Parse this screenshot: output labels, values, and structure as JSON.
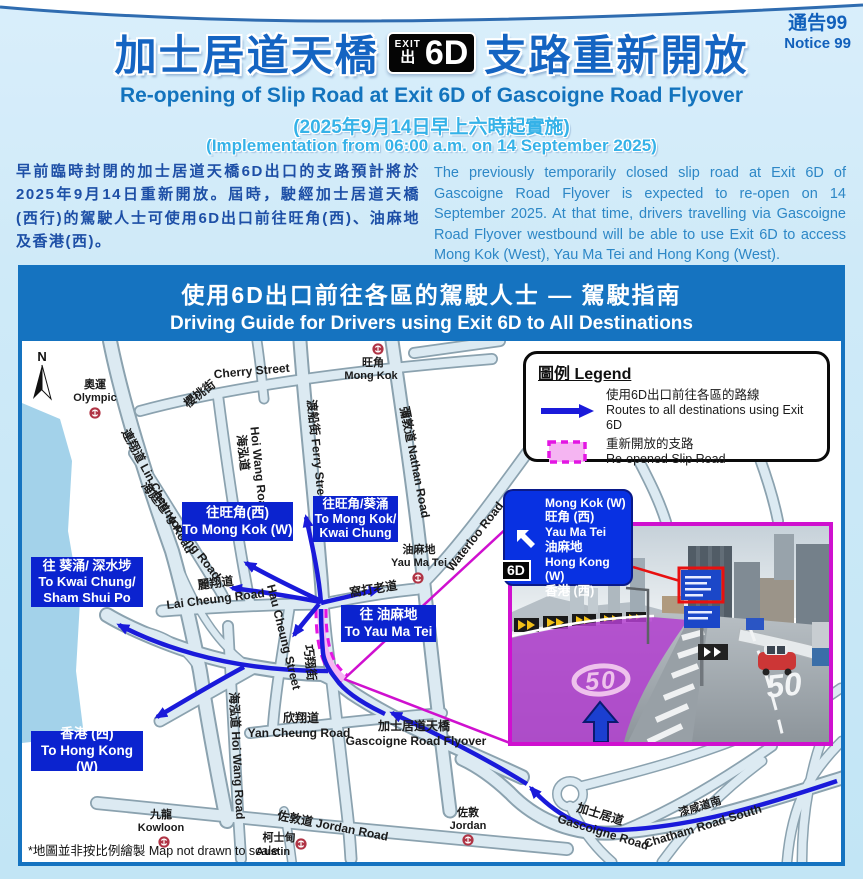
{
  "notice": {
    "zh": "通告99",
    "en": "Notice 99"
  },
  "header": {
    "title_zh_left": "加士居道天橋",
    "title_zh_right": "支路重新開放",
    "badge": {
      "exit_en": "EXIT",
      "exit_zh": "出",
      "code": "6D"
    },
    "title_en": "Re-opening of Slip Road at Exit 6D of Gascoigne Road Flyover",
    "date_zh": "(2025年9月14日早上六時起實施)",
    "date_en": "(Implementation from 06:00 a.m. on 14 September 2025)"
  },
  "intro": {
    "zh": "早前臨時封閉的加士居道天橋6D出口的支路預計將於2025年9月14日重新開放。屆時，駛經加士居道天橋(西行)的駕駛人士可使用6D出口前往旺角(西)、油麻地及香港(西)。",
    "en": "The previously temporarily closed slip road at Exit 6D of Gascoigne Road Flyover is expected to re-open on 14 September 2025. At that time, drivers travelling via Gascoigne Road Flyover westbound will be able to use Exit 6D to access Mong Kok (West), Yau Ma Tei and Hong Kong (West)."
  },
  "panel": {
    "title_zh": "使用6D出口前往各區的駕駛人士 — 駕駛指南",
    "title_en": "Driving Guide for Drivers using Exit 6D to All Destinations"
  },
  "legend": {
    "title": "圖例 Legend",
    "route_zh": "使用6D出口前往各區的路線",
    "route_en": "Routes to all destinations using Exit 6D",
    "slip_zh": "重新開放的支路",
    "slip_en": "Re-opened Slip Road"
  },
  "map": {
    "north": "N",
    "streets": [
      "Cherry Street",
      "櫻桃街",
      "連翔道 Lin Cheung Road",
      "海庭道 Hoi Ting Road",
      "海泓道",
      "Hoi Wang Road",
      "渡船街 Ferry Street",
      "彌敦道 Nathan Road",
      "Waterloo Road",
      "窩打老道",
      "麗翔道",
      "Lai Cheung Road",
      "巧翔街",
      "Hau Cheung Street",
      "海泓道 Hoi Wang Road",
      "欣翔道",
      "Yan Cheung Road",
      "加士居道天橋",
      "Gascoigne Road Flyover",
      "佐敦道 Jordan Road",
      "加士居道",
      "Gascoigne Road",
      "漆咸道南",
      "Chatham Road South"
    ],
    "stations": [
      {
        "zh": "奧運",
        "en": "Olympic"
      },
      {
        "zh": "旺角",
        "en": "Mong Kok"
      },
      {
        "zh": "油麻地",
        "en": "Yau Ma Tei"
      },
      {
        "zh": "九龍",
        "en": "Kowloon"
      },
      {
        "zh": "柯士甸",
        "en": "Austin"
      },
      {
        "zh": "佐敦",
        "en": "Jordan"
      }
    ],
    "dest_boxes": [
      {
        "lines": [
          "往旺角(西)",
          "To Mong Kok (W)"
        ]
      },
      {
        "lines": [
          "往旺角/葵涌",
          "To Mong Kok/",
          "Kwai Chung"
        ]
      },
      {
        "lines": [
          "往 葵涌/ 深水埗",
          "To Kwai Chung/",
          "Sham Shui Po"
        ]
      },
      {
        "lines": [
          "往 油麻地",
          "To Yau Ma Tei"
        ]
      },
      {
        "lines": [
          "香港 (西)",
          "To Hong Kong (W)"
        ]
      }
    ],
    "footnote_zh": "*地圖並非按比例繪製",
    "footnote_en": "Map not drawn to scale"
  },
  "sign": {
    "lines": [
      "Mong Kok (W)",
      "旺角 (西)",
      "Yau Ma Tei",
      "油麻地",
      "Hong Kong (W)",
      "香港 (西)"
    ],
    "exit_code": "6D"
  },
  "photo": {
    "speed_limit_left": "50",
    "speed_limit_right": "50"
  },
  "colors": {
    "panel_blue": "#1573c0",
    "route_blue": "#1a1ada",
    "dest_box_blue": "#0b23cf",
    "slip_fill": "#f5b5f2",
    "slip_edge": "#e316e3",
    "photo_border": "#cf10cf",
    "sign_blue": "#0831e2",
    "notice_text": "#1160bb",
    "water": "#a3d2ea"
  }
}
